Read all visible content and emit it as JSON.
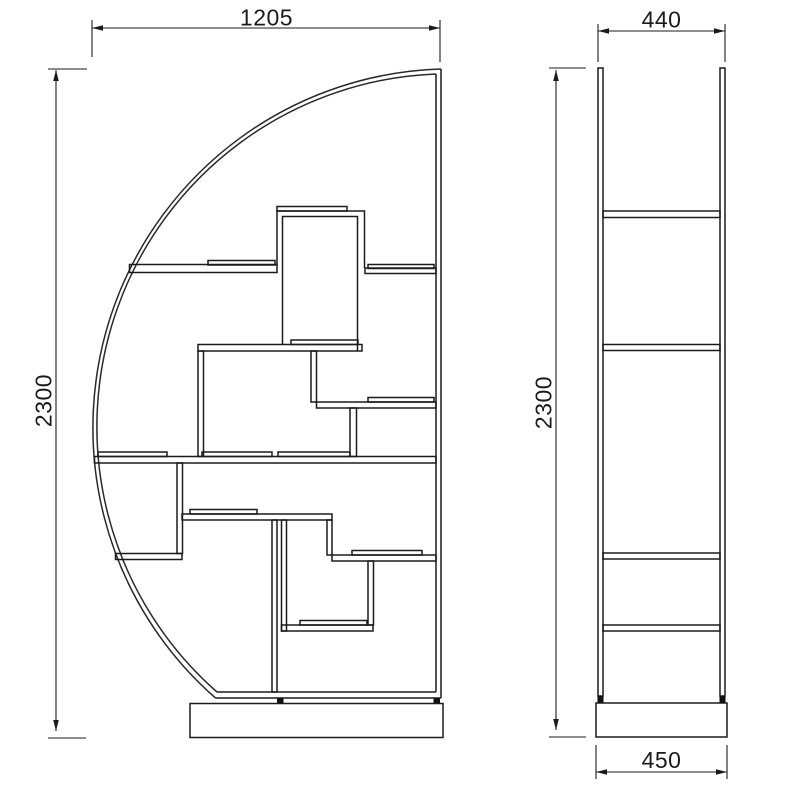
{
  "colors": {
    "line": "#1b1b1b",
    "background": "#ffffff"
  },
  "views": {
    "front": {
      "width_label": "1205",
      "height_label": "2300"
    },
    "side": {
      "depth_label": "440",
      "height_label": "2300",
      "base_depth_label": "450"
    }
  }
}
